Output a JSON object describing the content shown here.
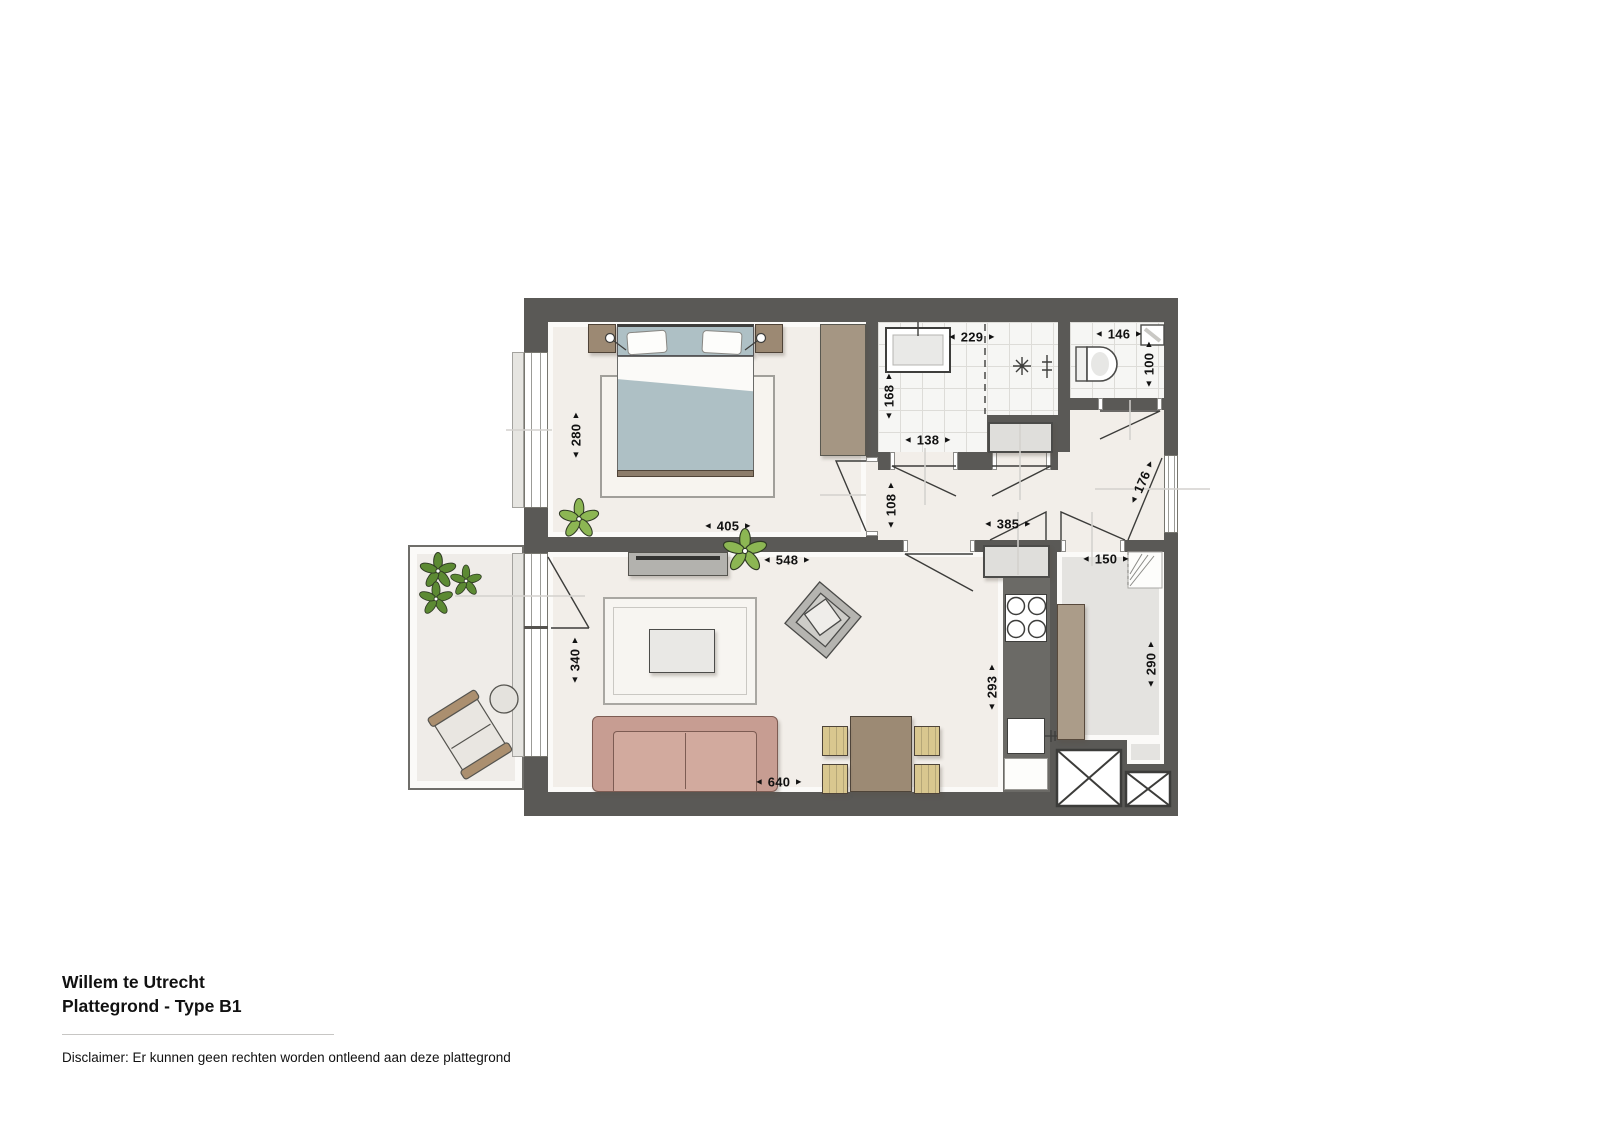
{
  "title": {
    "project": "Willem te Utrecht",
    "plan": "Plattegrond - Type B1"
  },
  "disclaimer": "Disclaimer: Er kunnen geen rechten worden ontleend aan deze plattegrond",
  "arrows": {
    "left": "◄",
    "right": "►"
  },
  "dimensions": [
    {
      "id": "bedroom-width",
      "value": "405",
      "orient": "h",
      "x": 728,
      "y": 526
    },
    {
      "id": "bedroom-depth",
      "value": "280",
      "orient": "v",
      "x": 576,
      "y": 435
    },
    {
      "id": "bathroom-width",
      "value": "229",
      "orient": "h",
      "x": 972,
      "y": 337
    },
    {
      "id": "bathroom-depth",
      "value": "168",
      "orient": "v",
      "x": 889,
      "y": 396
    },
    {
      "id": "bathroom-inner-width",
      "value": "138",
      "orient": "h",
      "x": 928,
      "y": 440
    },
    {
      "id": "toilet-width",
      "value": "146",
      "orient": "h",
      "x": 1119,
      "y": 334
    },
    {
      "id": "toilet-depth",
      "value": "100",
      "orient": "v",
      "x": 1149,
      "y": 364
    },
    {
      "id": "hall-width",
      "value": "108",
      "orient": "v",
      "x": 891,
      "y": 505
    },
    {
      "id": "hall-length",
      "value": "385",
      "orient": "h",
      "x": 1008,
      "y": 524
    },
    {
      "id": "entrance-door-width",
      "value": "176",
      "orient": "d",
      "x": 1142,
      "y": 482
    },
    {
      "id": "storage-width",
      "value": "150",
      "orient": "h",
      "x": 1106,
      "y": 559
    },
    {
      "id": "storage-depth",
      "value": "290",
      "orient": "v",
      "x": 1151,
      "y": 664
    },
    {
      "id": "living-depth",
      "value": "340",
      "orient": "v",
      "x": 575,
      "y": 660
    },
    {
      "id": "living-width",
      "value": "548",
      "orient": "h",
      "x": 787,
      "y": 560
    },
    {
      "id": "kitchen-depth",
      "value": "293",
      "orient": "v",
      "x": 992,
      "y": 687
    },
    {
      "id": "living-bottom-width",
      "value": "640",
      "orient": "h",
      "x": 779,
      "y": 782
    }
  ],
  "colors": {
    "wall": "#5a5956",
    "floor": "#f2eee9",
    "tile": "#f6f6f4",
    "tileline": "#dddcd8",
    "storage": "#e4e3e0",
    "counter": "#6b6a66",
    "sofa": "#c79d92",
    "sofaline": "#7d5c53",
    "wood": "#9c8a74",
    "chair": "#d9c78f",
    "wardrobe": "#a59683",
    "blanket": "#aec0c5",
    "plantlight": "#8cb653",
    "plantdark": "#5c8a33",
    "sideboard": "#b3b2ae"
  }
}
